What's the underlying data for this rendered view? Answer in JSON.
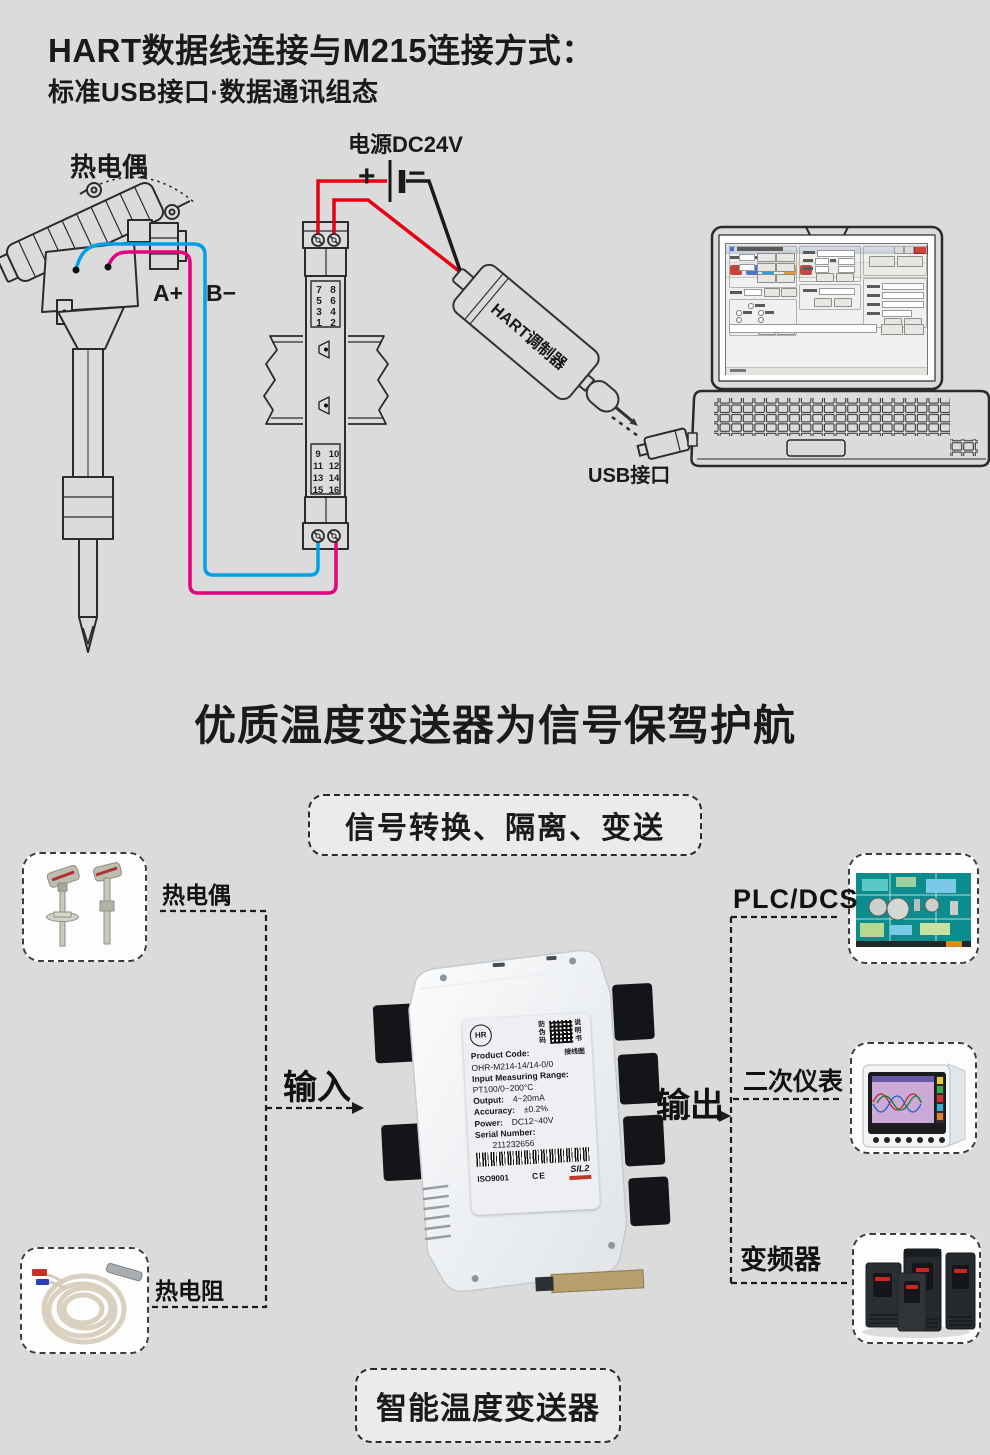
{
  "header": {
    "title": "HART数据线连接与M215连接方式：",
    "subtitle": "标准USB接口·数据通讯组态"
  },
  "wiring": {
    "thermocouple_label": "热电偶",
    "terminal_a_label": "A+",
    "terminal_b_label": "B−",
    "power_label": "电源DC24V",
    "power_plus": "+",
    "power_minus": "−",
    "modulator_label": "HART调制器",
    "usb_label": "USB接口",
    "top_terminals": [
      "7",
      "8",
      "5",
      "6",
      "3",
      "4",
      "1",
      "2"
    ],
    "bottom_terminals": [
      "9",
      "10",
      "11",
      "12",
      "13",
      "14",
      "15",
      "16"
    ],
    "colors": {
      "wire_red": "#e60012",
      "wire_blue": "#00a0e9",
      "wire_magenta": "#e4007f",
      "wire_black": "#1a1a1a"
    }
  },
  "banner": {
    "headline": "优质温度变送器为信号保驾护航",
    "tagline": "信号转换、隔离、变送",
    "footline": "智能温度变送器"
  },
  "flow": {
    "input_label": "输入",
    "output_label": "输出",
    "source_1": "热电偶",
    "source_2": "热电阻",
    "dest_1": "PLC/DCS",
    "dest_2": "二次仪表",
    "dest_3": "变频器"
  },
  "product_label": {
    "brand": "HR",
    "antifake": "防伪码",
    "manual": "说明书",
    "wiring_diagram": "接线图",
    "code_label": "Product Code:",
    "code_value": "OHR-M214-14/14-0/0",
    "range_label": "Input Measuring Range:",
    "range_value": "PT100/0~200°C",
    "output_label": "Output:",
    "output_value": "4~20mA",
    "accuracy_label": "Accuracy:",
    "accuracy_value": "±0.2%",
    "power_label": "Power:",
    "power_value": "DC12~40V",
    "serial_label": "Serial Number:",
    "serial_value": "211232656",
    "cert_iso": "ISO9001",
    "cert_ce": "CE",
    "cert_sil": "SIL2"
  }
}
